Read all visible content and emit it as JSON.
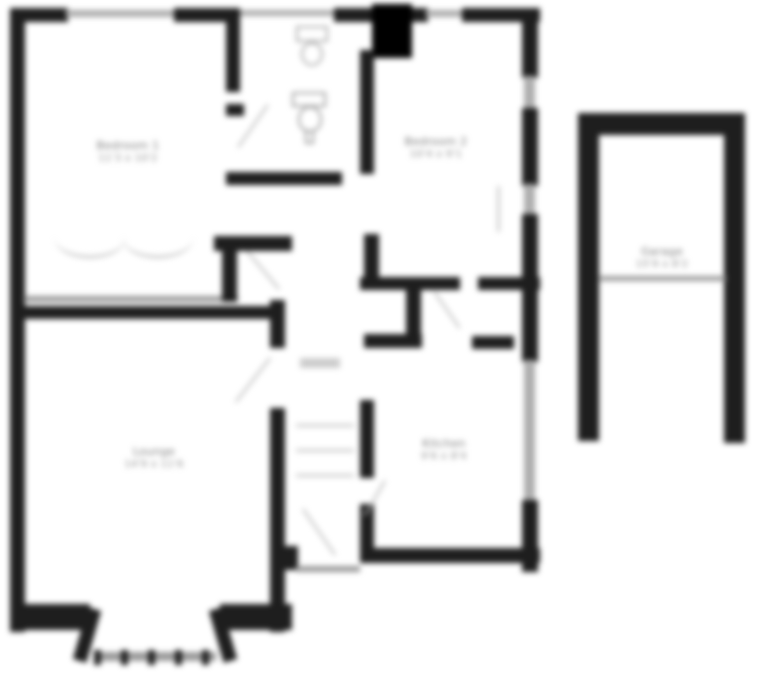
{
  "plan": {
    "type": "floorplan",
    "colors": {
      "background": "#ffffff",
      "wall": "#1e1e1e",
      "chimney": "#000000",
      "window_line": "#adadad",
      "thin_line": "#9a9a9a",
      "label_text": "#787878"
    },
    "rooms": [
      {
        "name": "bedroom-1",
        "label": "Bedroom 1",
        "dims": "11'3 x 10'2"
      },
      {
        "name": "bedroom-2",
        "label": "Bedroom 2",
        "dims": "10'4 x 9'1"
      },
      {
        "name": "lounge",
        "label": "Lounge",
        "dims": "14'9 x 11'6"
      },
      {
        "name": "kitchen",
        "label": "Kitchen",
        "dims": "9'6 x 8'4"
      },
      {
        "name": "garage",
        "label": "Garage",
        "dims": "15'9 x 8'2"
      }
    ],
    "features": [
      "bay-window",
      "chimney-breast",
      "staircase",
      "front-door",
      "wash-basin",
      "wc",
      "wardrobe-front",
      "garage-door-opening"
    ]
  }
}
